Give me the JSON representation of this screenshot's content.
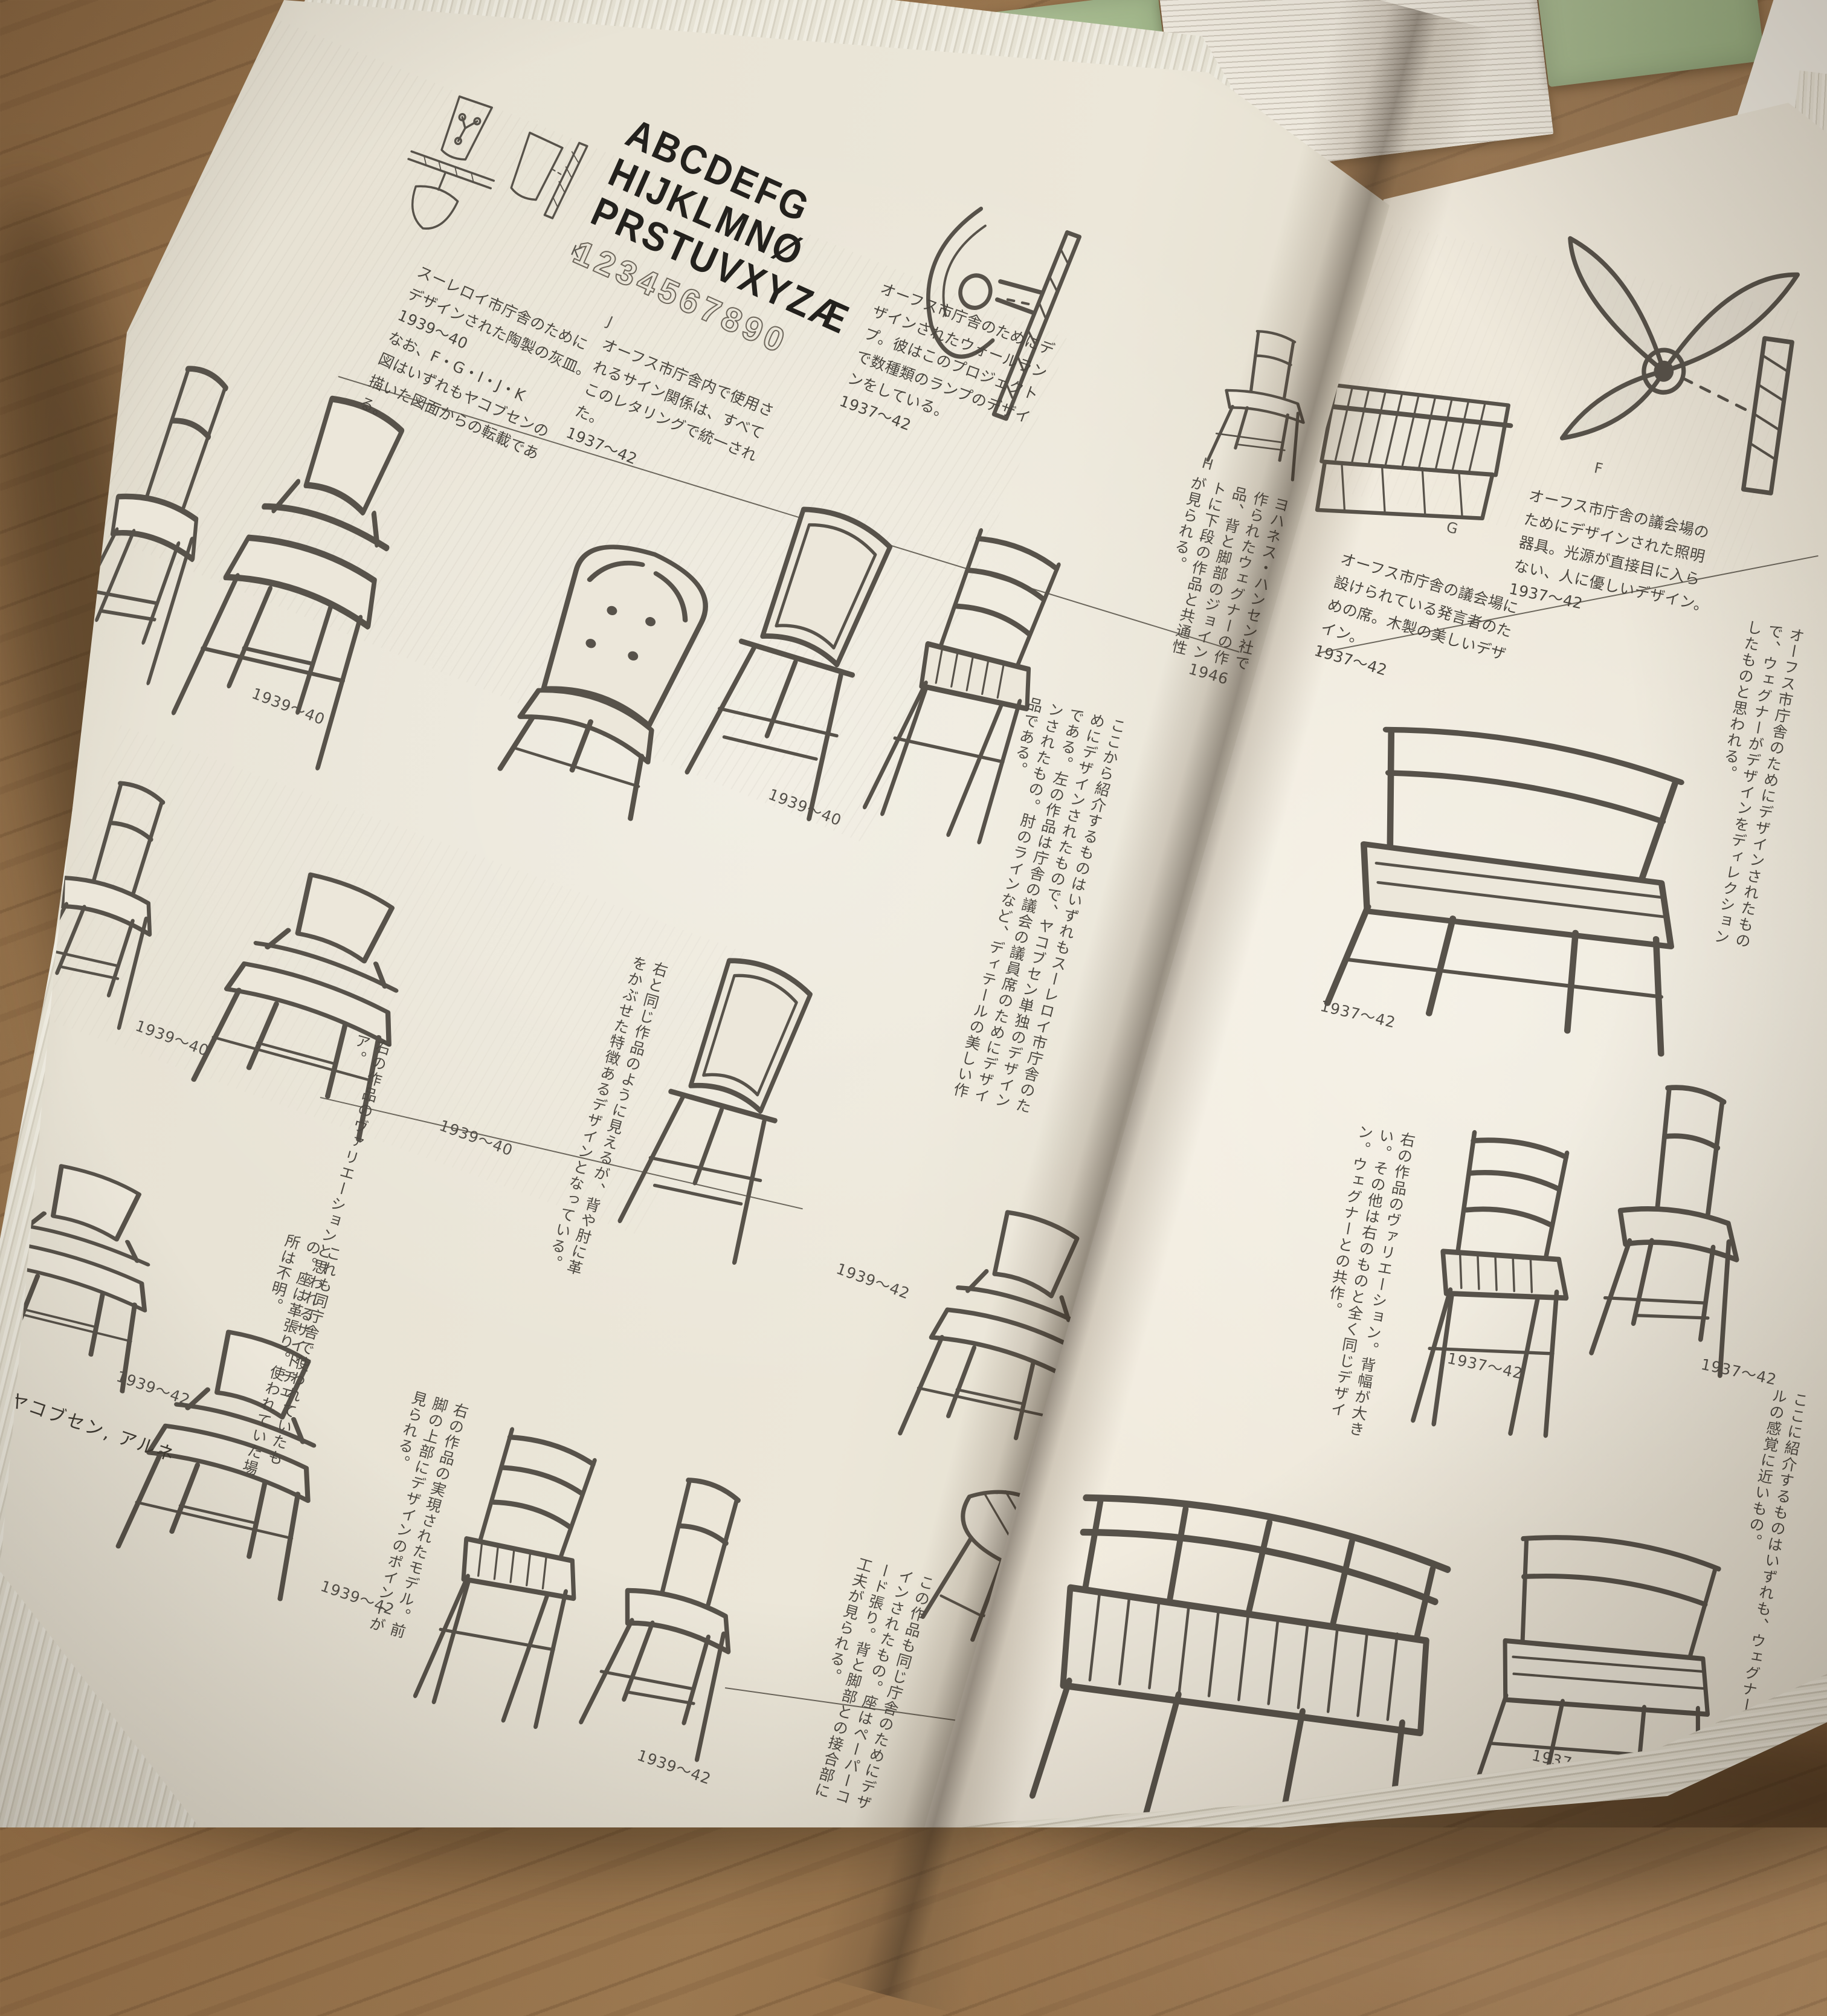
{
  "book": {
    "footer": "ヤコブセン, アルネ",
    "left_page": {
      "alphabet": {
        "l1": "ABCDEFG",
        "l2": "HIJKLMNØ",
        "l3": "PRSTUVXYZÆ",
        "nums": "1234567890"
      },
      "labels": {
        "k": "K",
        "j": "J",
        "h": "H"
      },
      "captions": {
        "ashtray": "スーレロイ市庁舎のために\nデザインされた陶製の灰皿。\n1939〜40\nなお、F・G・I・J・K\n図はいずれもヤコブセンの\n描いた図面からの転載であ\nる。",
        "lettering": "オーフス市庁舎内で使用さ\nれるサイン関係は、すべて\nこのレタリングで統一され\nた。\n1937〜42",
        "wall_lamp": "オーフス市庁舎のためにデ\nザインされたウォールラン\nプ。彼はこのプロジェクト\nで数種類のランプのデザイ\nンをしている。\n1937〜42",
        "hansen": "ヨハネス・ハンセン社で作られたウェグナーの作品、背と脚部のジョイントに下段の作品と共通性が見られる。",
        "hansen_date": "1946"
      },
      "notes": {
        "intro": "ここから紹介するものはいずれもスーレロイ市庁舎のためにデザインされたもので、ヤコブセン単独のデザインである。左の作品は庁舎の議会の議員席のためにデザインされたもの。肘のラインなど、ディテールの美しい作品である。",
        "variation": "右の作品のヴァリエーションと思われるサイドチェア。",
        "leather": "右と同じ作品のように見えるが、背や肘に革をかぶせた特徴あるデザインとなっている。",
        "same_hall": "これも同庁舎で使われていたもの。座は革張り。使われていた場所は不明。",
        "model": "右の作品の実現されたモデル。前脚の上部にデザインのポイントが見られる。",
        "papercord": "この作品も同じ庁舎のためにデザインされたもの。座はペーパーコード張り。背と脚部との接合部に工夫が見られる。",
        "secretary": "セクレタリーオフィス用アームチェア。図面のみで、使われていたかは不明。"
      },
      "dates": {
        "row1a": "1939〜40",
        "row1b": "1939〜40",
        "row2a": "1939〜40",
        "row2b": "1939〜40",
        "row2c": "1939〜42",
        "row3a": "1939〜42",
        "row3b": "1939〜42",
        "row3c": "1939〜42"
      }
    },
    "right_page": {
      "labels": {
        "g": "G",
        "f": "F"
      },
      "captions": {
        "speaker_seat": "オーフス市庁舎の議会場に\n設けられている発言者のた\nめの席。木製の美しいデザ\nイン。\n1937〜42",
        "lighting": "オーフス市庁舎の議会場の\nためにデザインされた照明\n器具。光源が直接目に入ら\nない、人に優しいデザイン。\n1937〜42"
      },
      "notes": {
        "direction": "オーフス市庁舎のためにデザインされたもので、ウェグナーがデザインをディレクションしたものと思われる。",
        "variation": "右の作品のヴァリエーション。背幅が大きい。その他は右のものと全く同じデザイン。ウェグナーとの共作。",
        "bottom": "ここに紹介するものはいずれも、ウェグナーとの共作。ルの感覚に近いもの。"
      },
      "dates": {
        "r1": "1937〜42",
        "r2": "1937〜42",
        "r3": "1937〜42",
        "r4": "1937〜42"
      }
    },
    "colors": {
      "green_book": "#a9bd92",
      "wood": "#96714a",
      "page": "#e9e3d5"
    }
  }
}
